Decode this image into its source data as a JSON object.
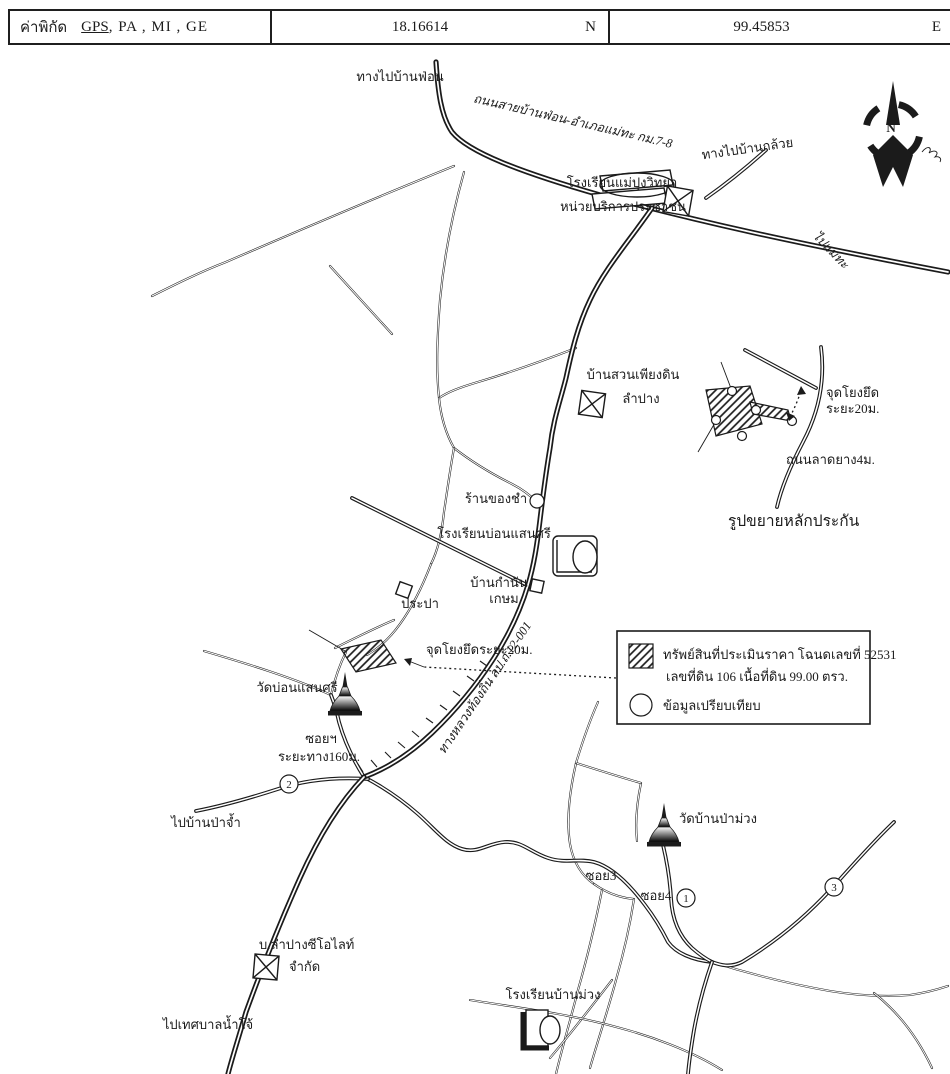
{
  "header": {
    "field_label": "ค่าพิกัด",
    "gps": "GPS",
    "other_methods": ",  PA  ,  MI  ,  GE",
    "latitude": "18.16614",
    "latitude_dir": "N",
    "longitude": "99.45853",
    "longitude_dir": "E"
  },
  "compass": {
    "north": "N"
  },
  "roads": {
    "to_ban_fon": "ทางไปบ้านฟ่อน",
    "main_road": "ถนนสายบ้านฟ่อน-อำเภอแม่ทะ กม.7-8",
    "to_ban_kluai": "ทางไปบ้านกล้วย",
    "to_mae_tha": "ไปแม่ทะ",
    "local_highway": "ทางหลวงท้องถิ่น ลป.ถ.12-001",
    "anchor_point": "จุดโยงยึดระยะ20ม.",
    "soi_line1": "ซอยฯ",
    "soi_line2": "ระยะทาง160ม.",
    "soi3": "ซอย3",
    "soi4": "ซอย4",
    "to_ban_pa_cham": "ไปบ้านป่าจ้ำ",
    "to_nam_cho": "ไปเทศบาลน้ำโจ้"
  },
  "places": {
    "school_mae_pung": "โรงเรียนแม่ปุงวิทยา",
    "service_unit": "หน่วยบริการประชาชน",
    "ban_suan_line1": "บ้านสวนเพียงดิน",
    "ban_suan_line2": "ลำปาง",
    "grocery": "ร้านของชำ",
    "school_bon_saen_si": "โรงเรียนบ่อนแสนศรี",
    "kamnan_line1": "บ้านกำนัน",
    "kamnan_line2": "เกษม",
    "waterworks": "ประปา",
    "wat_bon_saen_si": "วัดบ่อนแสนศรี",
    "wat_ban_pa_muang": "วัดบ้านป่าม่วง",
    "zeolite_line1": "บ.ลำปางซีโอไลท์",
    "zeolite_line2": "จำกัด",
    "school_ban_muang": "โรงเรียนบ้านม่วง"
  },
  "inset": {
    "anchor_line1": "จุดโยงยึด",
    "anchor_line2": "ระยะ20ม.",
    "paved_road": "ถนนลาดยาง4ม.",
    "title": "รูปขยายหลักประกัน"
  },
  "legend": {
    "property_line1": "ทรัพย์สินที่ประเมินราคา โฉนดเลขที่ 52531",
    "property_line2": "เลขที่ดิน 106 เนื้อที่ดิน 99.00 ตรว.",
    "comparison": "ข้อมูลเปรียบเทียบ"
  },
  "markers": {
    "point1": "1",
    "point2": "2",
    "point3": "3"
  },
  "colors": {
    "ink": "#1b1b1b",
    "paper": "#ffffff"
  }
}
